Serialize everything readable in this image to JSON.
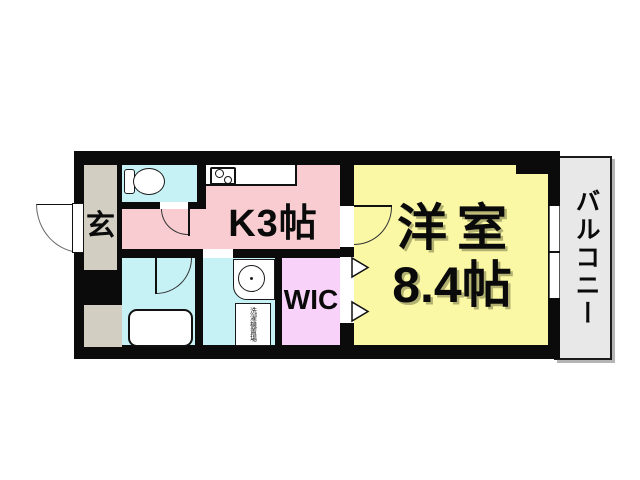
{
  "floorplan": {
    "entrance": {
      "label": "玄"
    },
    "kitchen": {
      "label": "K3帖"
    },
    "western_room": {
      "label_line1": "洋室",
      "label_line2": "8.4帖"
    },
    "wic": {
      "label": "WIC"
    },
    "balcony": {
      "label": "バルコニー"
    },
    "washer": {
      "label": "洗濯機置場"
    },
    "colors": {
      "wall": "#0b0b0b",
      "kitchen": "#f8ccd0",
      "western_room": "#faf8a5",
      "wic": "#f9d2f9",
      "wet_rooms": "#c6f2f5",
      "entrance": "#d2cec2",
      "balcony": "#e8e8e8",
      "fixture_line": "#1a1a1a"
    }
  }
}
